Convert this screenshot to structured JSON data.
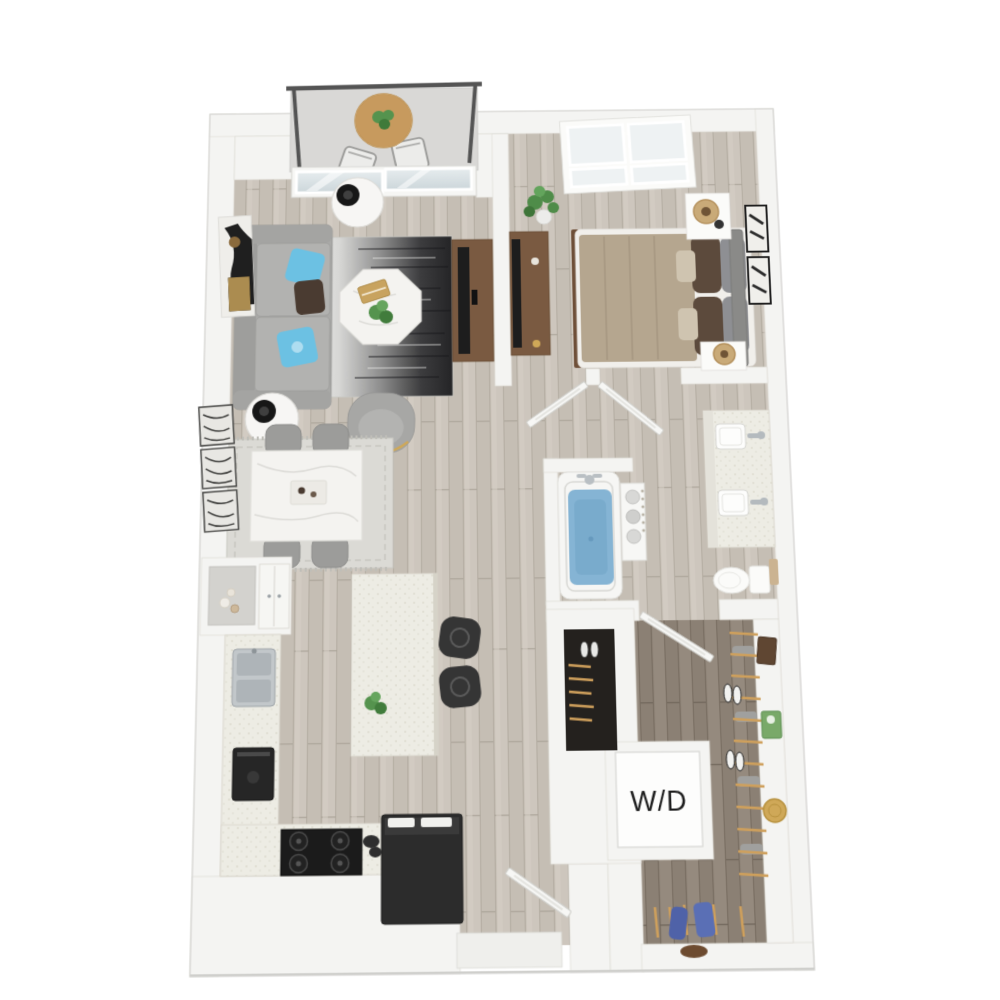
{
  "floor_plan": {
    "laundry_label": "W/D",
    "view": "3d-top-down-floor-plan",
    "rooms": [
      {
        "name": "balcony",
        "items": [
          "railing",
          "bistro-table",
          "balcony-chairs",
          "potted-plant",
          "sliding-glass-door"
        ]
      },
      {
        "name": "living-room",
        "items": [
          "sofa",
          "blue-pillows",
          "brown-pillow",
          "side-tables",
          "black-table-lamps",
          "octagon-coffee-table",
          "gradient-area-rug",
          "accent-chair",
          "tv-console",
          "tv",
          "wall-art"
        ]
      },
      {
        "name": "dining-area",
        "items": [
          "marble-dining-table",
          "dining-chairs",
          "patterned-rug",
          "abstract-wall-art"
        ]
      },
      {
        "name": "kitchen",
        "items": [
          "hutch-with-niche",
          "stainless-sink",
          "wall-oven",
          "gas-cooktop",
          "refrigerator",
          "kitchen-island",
          "bar-stools",
          "island-plant"
        ]
      },
      {
        "name": "bedroom",
        "items": [
          "bed",
          "tan-blanket",
          "accent-pillows",
          "headboard",
          "nightstands",
          "rattan-lamps",
          "dresser",
          "tv",
          "picture-window",
          "wall-art",
          "monstera-plant"
        ]
      },
      {
        "name": "bathroom",
        "items": [
          "bathtub",
          "towel-shelf",
          "double-sink-vanity",
          "toilet",
          "hand-towel"
        ]
      },
      {
        "name": "walk-in-closet",
        "items": [
          "hanging-rod",
          "wood-hangers",
          "sneakers",
          "storage-boxes",
          "green-box",
          "gold-basket",
          "hanging-clothes"
        ]
      },
      {
        "name": "coat-closet",
        "items": [
          "hangers",
          "shoes"
        ]
      },
      {
        "name": "laundry-closet",
        "items": [
          "washer-dryer-unit"
        ]
      },
      {
        "name": "entry",
        "items": [
          "front-door",
          "stoop"
        ]
      }
    ]
  },
  "palette": {
    "page_bg": "#ffffff",
    "wall": "#f4f4f2",
    "wall_outer": "#ebebe8",
    "wall_edge": "#dedcd6",
    "door": "#f7f7f5",
    "wood": "#cdc6bd",
    "wood_dark": "#94897d",
    "counter": "#edece4",
    "rug_dark": "#2b2b2d",
    "rug_light": "#dbdad5",
    "sofa": "#a9a9a7",
    "pillow_blue": "#6cc1e3",
    "pillow_brown": "#4a3b31",
    "marble": "#f4f3f0",
    "wood_brown": "#7a5a41",
    "tv_black": "#1d1d1d",
    "blanket_tan": "#b5a68f",
    "water_blue": "#85b4d4",
    "appliance_black": "#262626",
    "stool_black": "#353535",
    "plant_green": "#55934e",
    "hanger_tan": "#cfa05c",
    "box_green": "#79a969",
    "basket_gold": "#cfa858",
    "glass": "#dfe6e9",
    "concrete": "#d9d8d6",
    "label_text": "#1c1c1c"
  }
}
